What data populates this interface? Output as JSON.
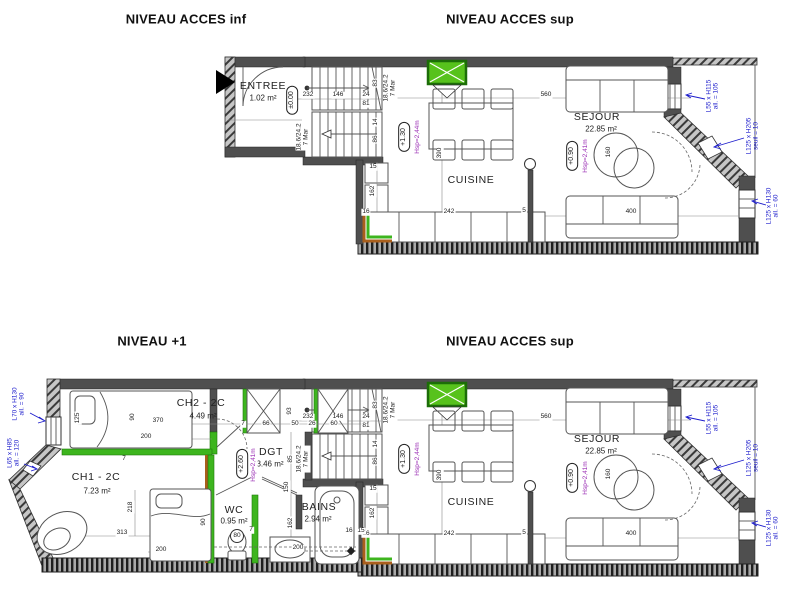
{
  "drawing": {
    "type": "architectural floor plan, two levels of a duplex"
  },
  "titles": {
    "upper_left": "NIVEAU ACCES inf",
    "upper_right": "NIVEAU ACCES sup",
    "lower_left": "NIVEAU +1",
    "lower_right": "NIVEAU ACCES sup"
  },
  "rooms": {
    "entree": {
      "name": "ENTREE",
      "area": "1.02 m²"
    },
    "cuisine": {
      "name": "CUISINE"
    },
    "sejour": {
      "name": "SEJOUR",
      "area": "22.85 m²"
    },
    "ch1": {
      "name": "CH1 - 2C",
      "area": "7.23 m²"
    },
    "ch2": {
      "name": "CH2 - 2C",
      "area": "4.49 m²"
    },
    "dgt": {
      "name": "DGT",
      "area": "3.46 m²"
    },
    "wc": {
      "name": "WC",
      "area": "0.95 m²"
    },
    "bains": {
      "name": "BAINS",
      "area": "2.94 m²"
    }
  },
  "level_markers": {
    "entree": "±0.00",
    "cuisine": "+1.30",
    "sejour": "+0.90",
    "dgt": "+2.60"
  },
  "ceiling_heights": {
    "cuisine": "Hsp=2,44m",
    "sejour": "Hsp=2,41m",
    "dgt": "Hsp=2,41m"
  },
  "stair_note": {
    "line1": "18.6/24.2",
    "line2": "7 Mar"
  },
  "window_tags": {
    "w55x115": {
      "size": "L55 x H115",
      "sill": "all. = 105"
    },
    "w125x205": {
      "size": "L125 x H205",
      "sill": "seuil = 10"
    },
    "w125x130": {
      "size": "L125 x H130",
      "sill": "all. = 60"
    },
    "w70x130": {
      "size": "L70 x H130",
      "sill": "all. = 90"
    },
    "w65x85": {
      "size": "L65 x H85",
      "sill": "all. = 120"
    }
  },
  "dims": {
    "d5": "5",
    "d7": "7",
    "d14": "14",
    "d15": "15",
    "d16": "16",
    "d24": "24",
    "d26": "26",
    "d50": "50",
    "d60": "60",
    "d66": "66",
    "d80": "80",
    "d81": "81",
    "d83": "83",
    "d85": "85",
    "d86": "86",
    "d90": "90",
    "d93": "93",
    "d125": "125",
    "d146": "146",
    "d150": "150",
    "d160": "160",
    "d162": "162",
    "d200": "200",
    "d218": "218",
    "d232": "232",
    "d242": "242",
    "d313": "313",
    "d370": "370",
    "d390": "390",
    "d400": "400",
    "d560": "560"
  },
  "colors": {
    "wall": "#4f4f4f",
    "new_partition_green": "#3db51e",
    "accent_orange": "#a95f1c",
    "annotation_blue": "#1c1ccc",
    "height_purple": "#9b2fb5"
  }
}
